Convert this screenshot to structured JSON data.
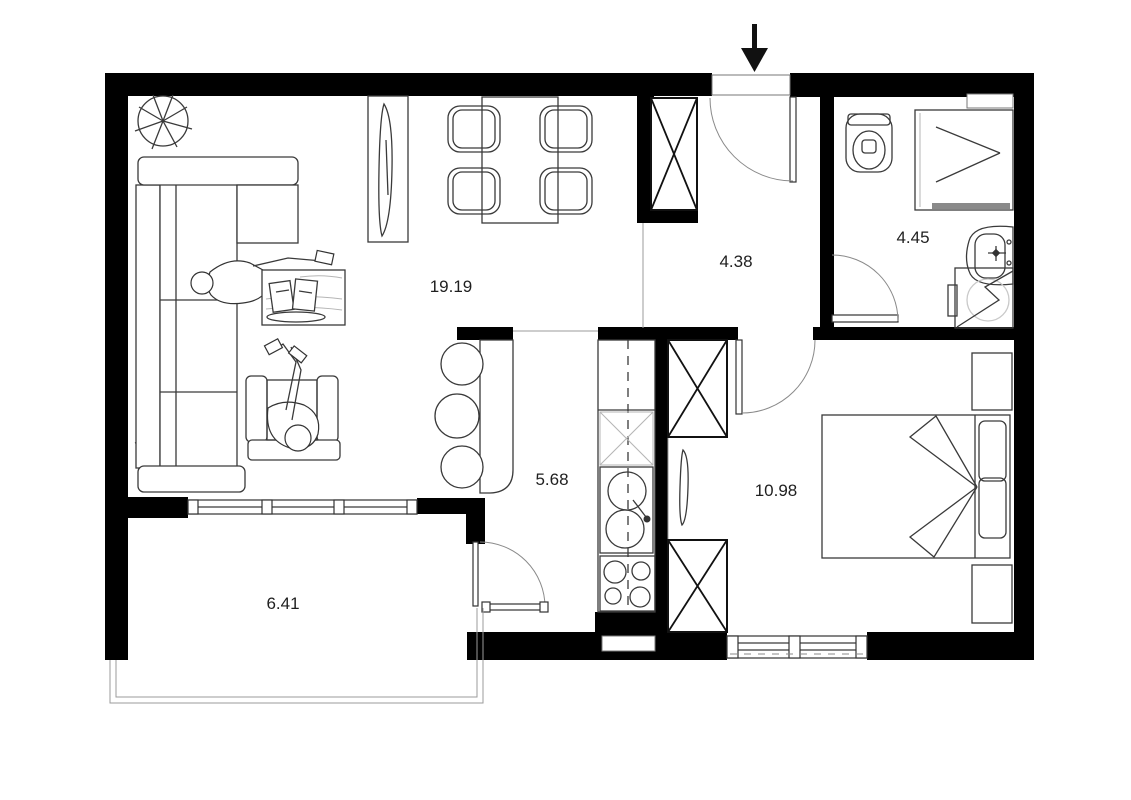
{
  "title": "apartment-floor-plan",
  "colors": {
    "wall": "#000000",
    "line": "#3a3a3a",
    "light_line": "#9b9b9b",
    "text": "#1f1f1f",
    "background": "#ffffff"
  },
  "entrance": {
    "direction": "down"
  },
  "rooms": [
    {
      "id": "living-room",
      "area_label": "19.19"
    },
    {
      "id": "hallway",
      "area_label": "4.38"
    },
    {
      "id": "bathroom",
      "area_label": "4.45"
    },
    {
      "id": "kitchen",
      "area_label": "5.68"
    },
    {
      "id": "bedroom",
      "area_label": "10.98"
    },
    {
      "id": "balcony",
      "area_label": "6.41"
    }
  ],
  "fixtures": [
    "entrance-arrow",
    "corner-sofa",
    "armchair",
    "coffee-table",
    "tv-sideboard",
    "dining-table",
    "dining-chairs",
    "plants",
    "bar-counter",
    "bar-stools",
    "kitchen-counter",
    "kitchen-sink",
    "stove",
    "hall-closet",
    "wardrobes",
    "bed",
    "nightstands",
    "toilet",
    "shower",
    "washbasin",
    "washing-machine",
    "windows",
    "balcony-railing",
    "doors"
  ]
}
